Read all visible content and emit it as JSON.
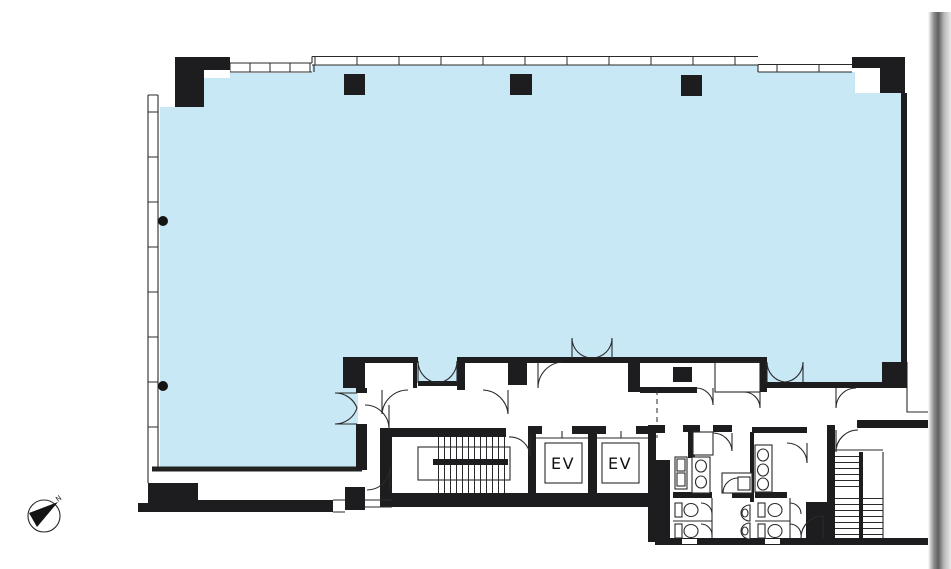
{
  "labels": {
    "elevator_1": "EV",
    "elevator_2": "EV",
    "compass_north": "N"
  },
  "colors": {
    "floor_fill": "#c8e8f5",
    "wall": "#1d1d1f",
    "line": "#2a2a2a",
    "blue_edge": "#222222",
    "scan_mid": "#5f5f5f",
    "paper": "#ffffff"
  }
}
